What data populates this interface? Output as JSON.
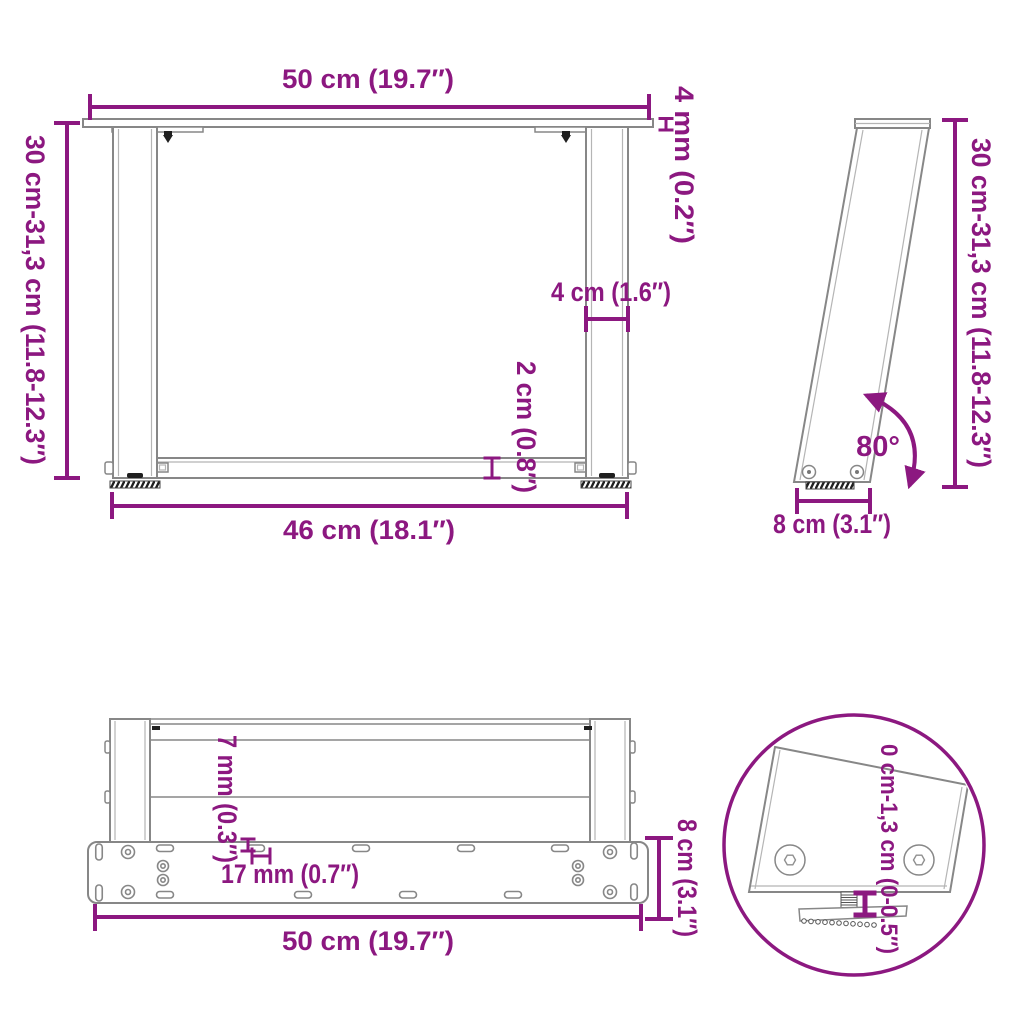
{
  "colors": {
    "accent": "#8C1880",
    "line": "#878787",
    "line_light": "#b5b5b5",
    "dark": "#1f1f1f",
    "background": "#ffffff"
  },
  "views": {
    "front": {
      "width_top": "50 cm (19.7″)",
      "top_thickness": "4 mm (0.2″)",
      "height_adjustable": "30 cm-31,3 cm (11.8-12.3″)",
      "leg_profile_width": "4 cm (1.6″)",
      "crossbar_thickness": "2 cm (0.8″)",
      "width_bottom": "46 cm (18.1″)"
    },
    "side": {
      "height_adjustable": "30 cm-31,3 cm (11.8-12.3″)",
      "leg_angle": "80°",
      "foot_depth": "8 cm (3.1″)"
    },
    "top": {
      "hole_depth": "7 mm (0.3″)",
      "slot_length": "17 mm (0.7″)",
      "plate_depth": "8 cm (3.1″)",
      "plate_width": "50 cm (19.7″)"
    },
    "detail": {
      "foot_height_adjustment": "0 cm-1,3 cm (0-0.5″)"
    }
  }
}
